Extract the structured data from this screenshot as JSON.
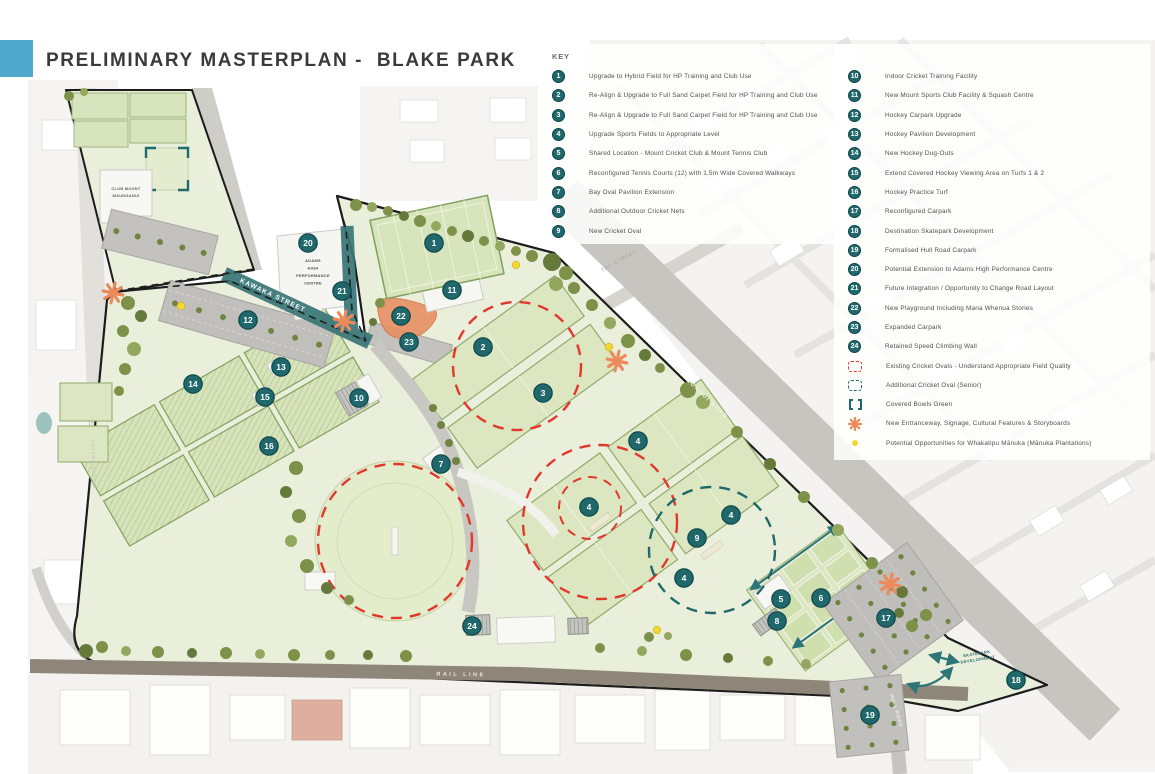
{
  "header": {
    "title": "PRELIMINARY MASTERPLAN -  BLAKE PARK"
  },
  "key": {
    "heading": "KEY",
    "items_left": [
      {
        "n": 1,
        "label": "Upgrade to Hybrid Field for HP Training and Club Use"
      },
      {
        "n": 2,
        "label": "Re-Align & Upgrade to Full Sand Carpet Field for HP Training and Club Use"
      },
      {
        "n": 3,
        "label": "Re-Align & Upgrade to Full Sand Carpet Field for HP Training and Club Use"
      },
      {
        "n": 4,
        "label": "Upgrade Sports Fields to Appropriate Level"
      },
      {
        "n": 5,
        "label": "Shared Location - Mount Cricket Club & Mount Tennis Club"
      },
      {
        "n": 6,
        "label": "Reconfigured Tennis Courts (12) with 1.5m Wide Covered Walkways"
      },
      {
        "n": 7,
        "label": "Bay Oval Pavilion Extension"
      },
      {
        "n": 8,
        "label": "Additional Outdoor Cricket Nets"
      },
      {
        "n": 9,
        "label": "New Cricket Oval"
      }
    ],
    "items_right": [
      {
        "n": 10,
        "label": "Indoor Cricket Training Facility"
      },
      {
        "n": 11,
        "label": "New Mount Sports Club Facility & Squash Centre"
      },
      {
        "n": 12,
        "label": "Hockey Carpark Upgrade"
      },
      {
        "n": 13,
        "label": "Hockey Pavilion Development"
      },
      {
        "n": 14,
        "label": "New Hockey Dug-Outs"
      },
      {
        "n": 15,
        "label": "Extend Covered Hockey Viewing Area on Turfs 1 & 2"
      },
      {
        "n": 16,
        "label": "Hockey Practice Turf"
      },
      {
        "n": 17,
        "label": "Reconfigured Carpark"
      },
      {
        "n": 18,
        "label": "Destination Skatepark Development"
      },
      {
        "n": 19,
        "label": "Formalised Hull Road Carpark"
      },
      {
        "n": 20,
        "label": "Potential Extension to Adams High Performance Centre"
      },
      {
        "n": 21,
        "label": "Future Integration / Opportunity to Change Road Layout"
      },
      {
        "n": 22,
        "label": "New Playground Including Mana Whenua Stories"
      },
      {
        "n": 23,
        "label": "Expanded Carpark"
      },
      {
        "n": 24,
        "label": "Retained Speed Climbing Wall"
      }
    ],
    "symbol_items": [
      {
        "symbol": "red-dashed-oval",
        "label": "Existing Cricket Ovals - Understand Appropriate Field Quality"
      },
      {
        "symbol": "teal-dashed-oval",
        "label": "Additional Cricket Oval (Senior)"
      },
      {
        "symbol": "teal-bracket",
        "label": "Covered Bowls Green"
      },
      {
        "symbol": "orange-asterisk",
        "label": "New Entranceway, Signage, Cultural Features & Storyboards"
      },
      {
        "symbol": "yellow-dot",
        "label": "Potential Opportunities for Whakatipu Mānuka (Mānuka Plantations)"
      }
    ]
  },
  "map": {
    "labels": {
      "tawa": "TAWA STREET",
      "kawaka": "KAWAKA STREET",
      "tay": "TAY STREET",
      "maunganui": "MAUNGANUI ROAD",
      "totara": "TOTARA STREET",
      "rail": "RAIL LINE",
      "hull": "HULL ROAD",
      "club1": "CLUB MOUNT",
      "club2": "MAUNGANUI",
      "adams1": "ADAMS",
      "adams2": "HIGH",
      "adams3": "PERFORMANCE",
      "adams4": "CENTRE",
      "skate1": "SKATEPARK",
      "skate2": "DEVELOPMENT"
    },
    "badges": [
      {
        "n": 1,
        "x": 434,
        "y": 243
      },
      {
        "n": 2,
        "x": 483,
        "y": 347
      },
      {
        "n": 3,
        "x": 543,
        "y": 393
      },
      {
        "n": 4,
        "x": 638,
        "y": 441
      },
      {
        "n": 4,
        "x": 589,
        "y": 507
      },
      {
        "n": 4,
        "x": 731,
        "y": 515
      },
      {
        "n": 4,
        "x": 684,
        "y": 578
      },
      {
        "n": 5,
        "x": 781,
        "y": 599
      },
      {
        "n": 6,
        "x": 821,
        "y": 598
      },
      {
        "n": 7,
        "x": 441,
        "y": 464
      },
      {
        "n": 8,
        "x": 777,
        "y": 621
      },
      {
        "n": 9,
        "x": 697,
        "y": 538
      },
      {
        "n": 10,
        "x": 359,
        "y": 398
      },
      {
        "n": 11,
        "x": 452,
        "y": 290
      },
      {
        "n": 12,
        "x": 248,
        "y": 320
      },
      {
        "n": 13,
        "x": 281,
        "y": 367
      },
      {
        "n": 14,
        "x": 193,
        "y": 384
      },
      {
        "n": 15,
        "x": 265,
        "y": 397
      },
      {
        "n": 16,
        "x": 269,
        "y": 446
      },
      {
        "n": 17,
        "x": 886,
        "y": 618
      },
      {
        "n": 18,
        "x": 1016,
        "y": 680
      },
      {
        "n": 19,
        "x": 870,
        "y": 715
      },
      {
        "n": 20,
        "x": 308,
        "y": 243
      },
      {
        "n": 21,
        "x": 342,
        "y": 291
      },
      {
        "n": 22,
        "x": 401,
        "y": 316
      },
      {
        "n": 23,
        "x": 409,
        "y": 342
      },
      {
        "n": 24,
        "x": 472,
        "y": 626
      }
    ],
    "asterisks": [
      {
        "x": 113,
        "y": 293
      },
      {
        "x": 344,
        "y": 321
      },
      {
        "x": 617,
        "y": 361
      },
      {
        "x": 890,
        "y": 584
      }
    ],
    "manuka_dots": [
      {
        "x": 181,
        "y": 306
      },
      {
        "x": 516,
        "y": 265
      },
      {
        "x": 609,
        "y": 347
      },
      {
        "x": 657,
        "y": 630
      }
    ]
  },
  "colors": {
    "badge": "#20686B",
    "badge_border": "#0D4648",
    "red": "#E0392D",
    "teal": "#20696B",
    "orange": "#ED8A5C",
    "yellow": "#F2D832",
    "title_blue": "#4FA8CB"
  }
}
